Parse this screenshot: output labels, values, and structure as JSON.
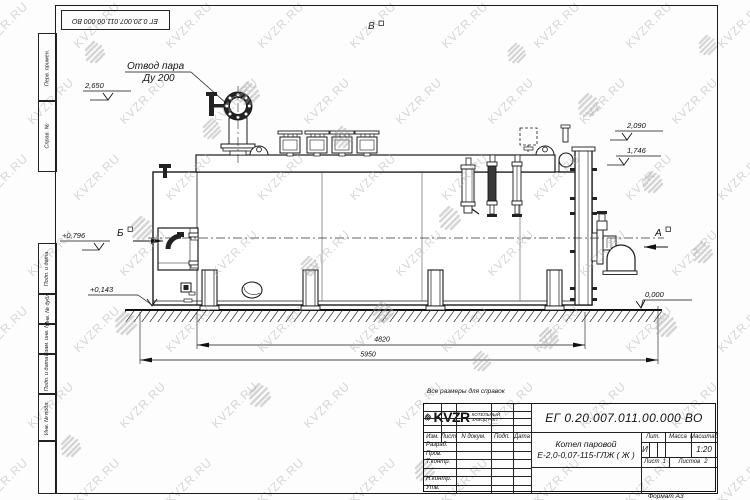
{
  "watermark": {
    "text": "KVZR.RU"
  },
  "frame": {
    "top_stamp_number": "ЕГ 0.20.007.011.00.000 ВО",
    "margin_labels": [
      {
        "label": "Перв. примен."
      },
      {
        "label": "Справ. №"
      },
      {
        "label": "Подп. и дата"
      },
      {
        "label": "Инв. № дубл."
      },
      {
        "label": "Взам. инв. №"
      },
      {
        "label": "Подп. и дата"
      },
      {
        "label": "Инв. № подл."
      }
    ]
  },
  "annotations": {
    "steam_outlet": {
      "line1": "Отвод пара",
      "line2": "Ду 200"
    },
    "views": {
      "a": "А",
      "b": "Б",
      "v": "В"
    },
    "elevations": {
      "steam_valve": "2,650",
      "right_upper": "2,090",
      "right_lower": "1,746",
      "burner_axis": "+0,796",
      "base_rail": "+0,143",
      "ground": "0,000"
    },
    "dimensions": {
      "boiler_length": "4820",
      "overall_length": "5950"
    }
  },
  "note": "Все размеры для справок",
  "title_block": {
    "doc_number": "ЕГ 0.20.007.011.00.000 ВО",
    "product_name_line1": "Котел паровой",
    "product_name_line2": "Е-2,0-0,07-115-ГЛЖ ( Ж )",
    "header_cols": {
      "izm": "Изм.",
      "list": "Лист",
      "n_dokum": "N докум.",
      "podp": "Подп.",
      "data": "Дата"
    },
    "sig_rows": [
      "Разраб.",
      "Пров.",
      "Т.контр.",
      "",
      "Н.контр.",
      "Утв."
    ],
    "lit_label": "Лит.",
    "lit_value": "И",
    "mass_label": "Масса",
    "scale_label": "Масштаб",
    "scale_value": "1:20",
    "sheet_label": "Лист",
    "sheet_num": "1",
    "sheets_label": "Листов",
    "sheets_num": "2",
    "logo_text": "KVZR",
    "logo_sub1": "КОТЕЛЬНЫЙ",
    "logo_sub2": "ЗАВОД РЭП",
    "format_note": "Формат А3"
  }
}
